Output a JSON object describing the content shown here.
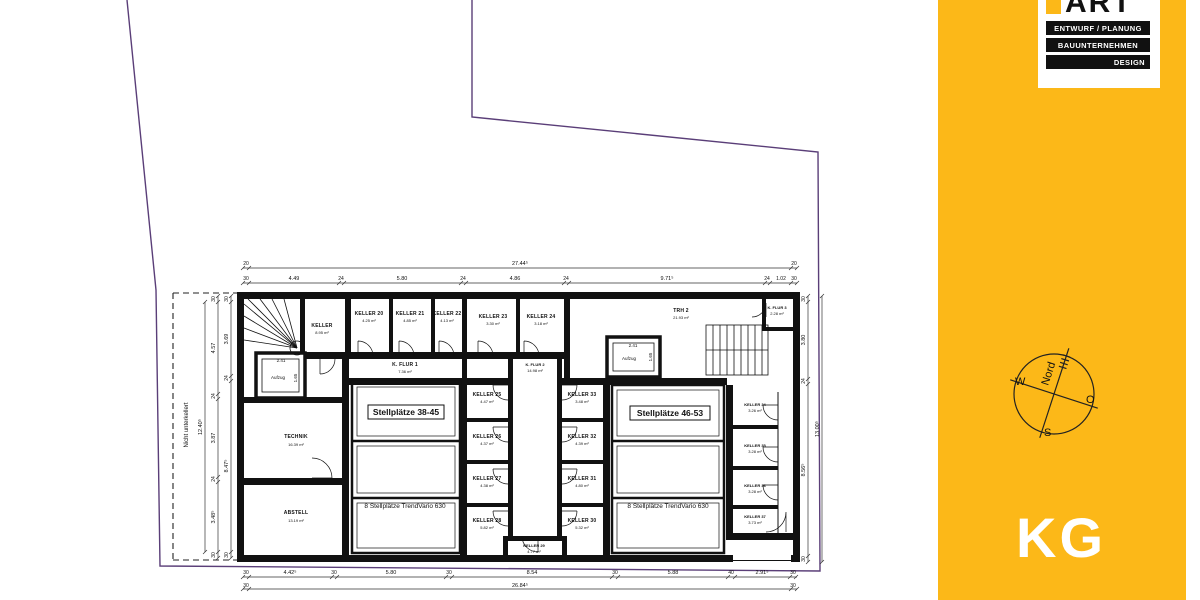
{
  "sidebar": {
    "bg_color": "#FCB818",
    "logo": {
      "brand": "ART",
      "line1": "ENTWURF / PLANUNG",
      "line2": "BAUUNTERNEHMEN",
      "line3": "DESIGN"
    },
    "compass": {
      "north": "Nord",
      "west": "W",
      "east": "O",
      "south": "S"
    },
    "floor_label": "KG"
  },
  "plan": {
    "site_note": "Nicht unterkellert",
    "parking_left": {
      "title": "Stellplätze 38-45",
      "note": "8 Stellplätze TrendVario 630"
    },
    "parking_right": {
      "title": "Stellplätze 46-53",
      "note": "8 Stellplätze TrendVario 630"
    },
    "elevator1": {
      "label": "Aufzug",
      "w": "2.41",
      "d": "1.65"
    },
    "elevator2": {
      "label": "Aufzug",
      "w": "2.41",
      "d": "1.65"
    },
    "rooms": {
      "keller": {
        "name": "KELLER",
        "area": "8.95 m²"
      },
      "k20": {
        "name": "KELLER 20",
        "area": "4.25 m²"
      },
      "k21": {
        "name": "KELLER 21",
        "area": "4.85 m²"
      },
      "k22": {
        "name": "KELLER 22",
        "area": "4.13 m²"
      },
      "kflur1": {
        "name": "K. FLUR 1",
        "area": "7.36 m²"
      },
      "k23": {
        "name": "KELLER 23",
        "area": "3.30 m²"
      },
      "k24": {
        "name": "KELLER 24",
        "area": "3.18 m²"
      },
      "kflur2": {
        "name": "K. FLUR 2",
        "area": "14.98 m²"
      },
      "trh2": {
        "name": "TRH 2",
        "area": "21.93 m²"
      },
      "kflur3": {
        "name": "K. FLUR 3",
        "area": "2.28 m²"
      },
      "k25": {
        "name": "KELLER 25",
        "area": "4.47 m²"
      },
      "k26": {
        "name": "KELLER 26",
        "area": "4.37 m²"
      },
      "k27": {
        "name": "KELLER 27",
        "area": "4.38 m²"
      },
      "k28": {
        "name": "KELLER 28",
        "area": "5.82 m²"
      },
      "k29": {
        "name": "KELLER 29",
        "area": "4.77 m²"
      },
      "k30": {
        "name": "KELLER 30",
        "area": "5.32 m²"
      },
      "k31": {
        "name": "KELLER 31",
        "area": "4.80 m²"
      },
      "k32": {
        "name": "KELLER 32",
        "area": "4.39 m²"
      },
      "k33": {
        "name": "KELLER 33",
        "area": "3.48 m²"
      },
      "k34": {
        "name": "KELLER 34",
        "area": "3.26 m²"
      },
      "k35": {
        "name": "KELLER 35",
        "area": "3.28 m²"
      },
      "k36": {
        "name": "KELLER 36",
        "area": "3.28 m²"
      },
      "k37": {
        "name": "KELLER 37",
        "area": "3.73 m²"
      },
      "technik": {
        "name": "TECHNIK",
        "area": "16.39 m²"
      },
      "abstell": {
        "name": "ABSTELL",
        "area": "13.19 m²"
      }
    }
  },
  "dims": {
    "top1": [
      "20",
      "27.44⁵",
      "20"
    ],
    "top2": [
      "30",
      "4.49",
      "24",
      "5.80",
      "24",
      "4.86",
      "24",
      "9.71⁵",
      "24",
      "1.02",
      "30"
    ],
    "bottom1": [
      "30",
      "4.42⁵",
      "30",
      "5.80",
      "30",
      "8.54",
      "30",
      "5.88",
      "40",
      "2.91⁵",
      "30"
    ],
    "bottom2": [
      "30",
      "26.84⁵",
      "30"
    ],
    "left_outer": "12.40⁵",
    "left_mid": [
      "30",
      "4.57",
      "24",
      "3.87",
      "24",
      "3.48⁵",
      "30"
    ],
    "left_inner": [
      "30",
      "3.69",
      "24",
      "8.47⁵",
      "30"
    ],
    "right_inner": [
      "30",
      "3.80",
      "24",
      "8.56⁵",
      "30"
    ],
    "right_outer": "13.00⁵"
  }
}
